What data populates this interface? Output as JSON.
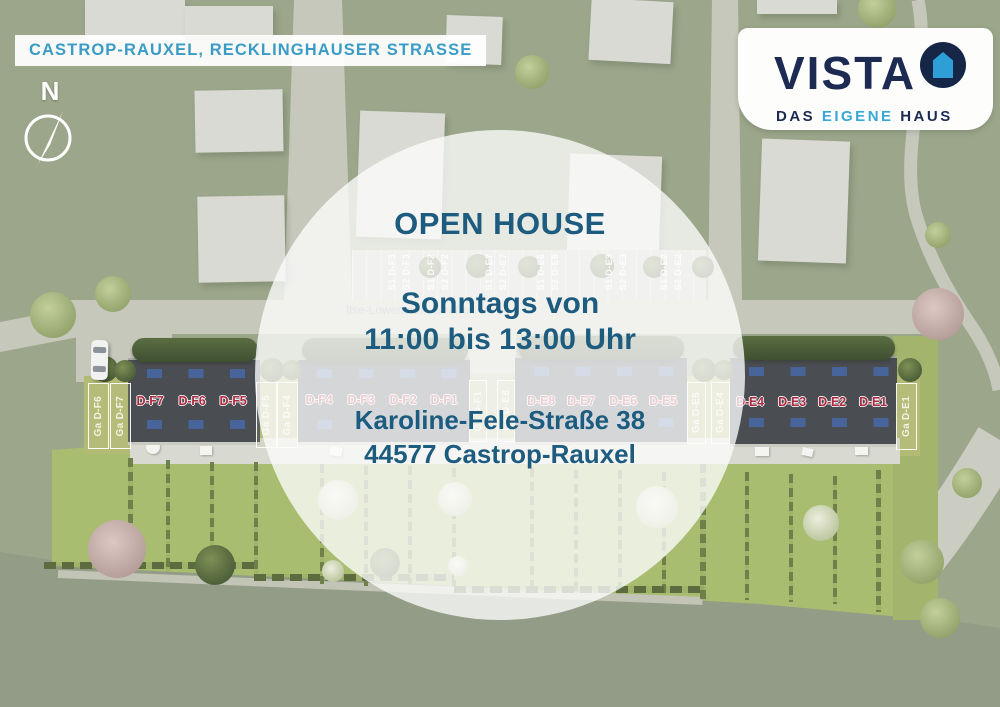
{
  "banner": {
    "text": "CASTROP-RAUXEL, RECKLINGHAUSER STRASSE"
  },
  "logo": {
    "brand": "VISTA",
    "tagline": [
      "DAS",
      "EIGENE",
      "HAUS"
    ]
  },
  "compass": {
    "label": "N"
  },
  "open_house": {
    "title": "OPEN HOUSE",
    "schedule_line1": "Sonntags von",
    "schedule_line2": "11:00 bis 13:00 Uhr",
    "address_line1": "Karoline-Fele-Straße 38",
    "address_line2": "44577 Castrop-Rauxel"
  },
  "site_plan": {
    "street_label": "Ilse-Löwenstein-Straße",
    "row_f_west_units": [
      "D-F7",
      "D-F6",
      "D-F5"
    ],
    "row_f_east_units": [
      "D-F4",
      "D-F3",
      "D-F2",
      "D-F1"
    ],
    "row_e_west_units": [
      "D-E8",
      "D-E7",
      "D-E6",
      "D-E5"
    ],
    "row_e_east_units": [
      "D-E4",
      "D-E3",
      "D-E2",
      "D-E1"
    ],
    "garage_labels": [
      "Ga D-F6",
      "Ga D-F7",
      "Ga D-F5",
      "Ga D-F4",
      "Ga D-F1",
      "Ga D-E8",
      "Ga D-E5",
      "Ga D-E4",
      "Ga D-E1"
    ],
    "parking_labels": [
      "S1 D-F3",
      "S2 D-F3",
      "S1 D-F2",
      "S2 D-F2",
      "S1 D-E7",
      "S2 D-E7",
      "S1 D-E6",
      "S2 D-E6",
      "S1 D-E3",
      "S2 D-E3",
      "S1 D-E2",
      "S2 D-E2"
    ]
  },
  "colors": {
    "heading_teal": "#1d5c7f",
    "banner_text_blue": "#3a9cc6",
    "brand_navy": "#1d2b52",
    "brand_sky": "#35a8d8",
    "unit_label_red": "#ab2b42",
    "roof_gray": "#4a4d52",
    "garden_green": "#a9bd70"
  }
}
